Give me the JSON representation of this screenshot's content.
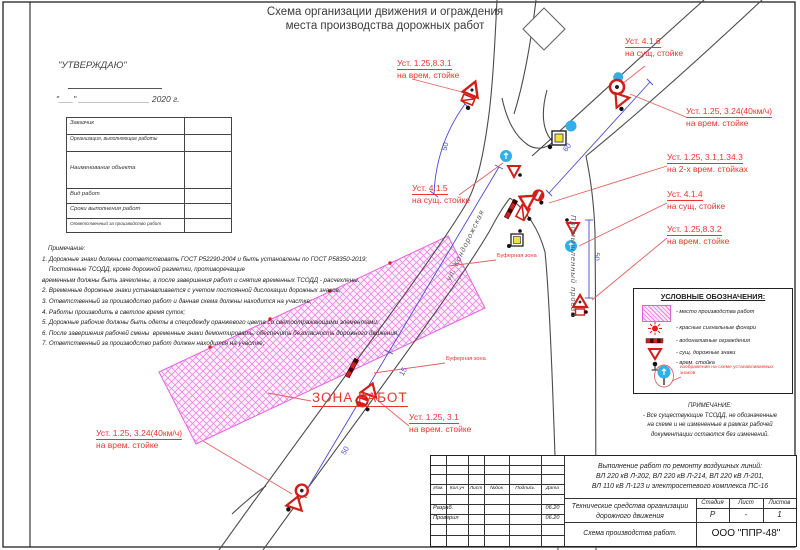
{
  "sheet": {
    "title_line1": "Схема организации движения и ограждения",
    "title_line2": "места производства дорожных работ"
  },
  "approval": {
    "stamp": "\"УТВЕРЖДАЮ\"",
    "date_line": "\"___\" _______________ 2020 г."
  },
  "form": {
    "rows": [
      {
        "label": "Заказчик"
      },
      {
        "label": "Организация, выполняющие работы"
      },
      {
        "label": "Наименование объекта"
      },
      {
        "label": "Вид работ"
      },
      {
        "label": "Сроки выполнения работ"
      },
      {
        "label": "Ответственный за производство работ"
      }
    ]
  },
  "notes": {
    "heading": "Примечание:",
    "lines": [
      "1. Дорожные знаки должны соответствовать ГОСТ Р52290-2004 и быть установлены по ГОСТ Р58350-2019;",
      "    Постоянные ТСОДД, кроме дорожной разметки, противоречащие",
      "временным должны быть зачехлены, а после завершения работ и снятия временных ТСОДД - расчехлены.",
      "2. Временные дорожные знаки устанавливается с учетом постоянной дислокации дорожных знаков;",
      "3. Ответственный за производство работ и данная схема должны находится на участке;",
      "4. Работы производить в светлое время суток;",
      "5. Дорожные рабочие должны быть одеты в спецодежду оранжевого цвета со светоотражающими элементами;",
      "6. После завершения рабочей смены  временные знаки демонтировать, обеспечить безопасность дорожного движения;",
      "7. Ответственный за производство работ должен находится на участке;"
    ]
  },
  "diagram": {
    "work_zone_label": "ЗОНА РАБОТ",
    "buffer_zone_label_1": "Буферная зона",
    "buffer_zone_label_2": "Буферная зона",
    "street_1": "ул. Кондорожская",
    "street_2": "Промышленный проезд",
    "callouts": [
      {
        "line1": "Уст.  1.25,8.3.1",
        "line2": "на врем, стойке"
      },
      {
        "line1": "Уст.  4.1.6",
        "line2": "на сущ, стойке"
      },
      {
        "line1": "Уст.  1.25, 3.24(40км/ч)",
        "line2": "на врем. стойке"
      },
      {
        "line1": "Уст.  1.25, 3.1,1.34.3",
        "line2": "на 2-х  врем. стойках"
      },
      {
        "line1": "Уст.  4.1.4",
        "line2": "на сущ, стойке"
      },
      {
        "line1": "Уст.  1.25,8.3.2",
        "line2": "на врем. стойке"
      },
      {
        "line1": "Уст.  4.1.5",
        "line2": "на сущ. стойке"
      },
      {
        "line1": "Уст.  1.25, 3.1",
        "line2": "на врем. стойке"
      },
      {
        "line1": "Уст.  1.25, 3.24(40км/ч)",
        "line2": "на врем. стойке"
      }
    ],
    "dimensions": {
      "arc": "50",
      "upper": "60",
      "side_road": "50",
      "buffer": "15",
      "lower": "50"
    }
  },
  "legend": {
    "title": "УСЛОВНЫЕ ОБОЗНАЧЕНИЯ:",
    "items": [
      "- место производства работ",
      "- красные сигнальные фонари",
      "- водоналивные ограждения",
      "- сущ. дорожные знаки",
      "- врем. стойка"
    ],
    "signs_note": "изображения на схеме устанавливаемых знаков",
    "note_title": "ПРИМЕЧАНИЕ:",
    "note_lines": [
      "- Все существующие ТСОДД, не обозначенные",
      "на схеме и не измененные в рамках рабочей",
      "документации остаются без изменений."
    ]
  },
  "titleblock": {
    "columns": [
      "Изм.",
      "Кол.уч",
      "Лист",
      "№док",
      "Подпись",
      "Дата"
    ],
    "rows": [
      {
        "role": "Разраб.",
        "date": "06.20"
      },
      {
        "role": "Проверил",
        "date": "06.20"
      }
    ],
    "project_line1": "Выполнение работ по ремонту воздушных линий:",
    "project_line2": "ВЛ 220 кВ Л-202, ВЛ 220 кВ Л-214, ВЛ 220 кВ Л-201,",
    "project_line3": "ВЛ 110 кВ Л-123 и электросетевого комплекса ПС-16",
    "doc_title_line1": "Технические средства организации",
    "doc_title_line2": "дорожного движения",
    "stage_label": "Стадия",
    "sheet_label": "Лист",
    "sheets_label": "Листов",
    "stage_value": "Р",
    "sheet_value": "-",
    "sheets_value": "1",
    "scheme_label": "Схема производства работ.",
    "company": "ООО \"ППР-48\""
  },
  "colors": {
    "callout_red": "#e8362e",
    "dimension_blue": "#4a4ad6",
    "zone_magenta": "#e85ae0",
    "sign_blue": "#2fb0e8"
  }
}
